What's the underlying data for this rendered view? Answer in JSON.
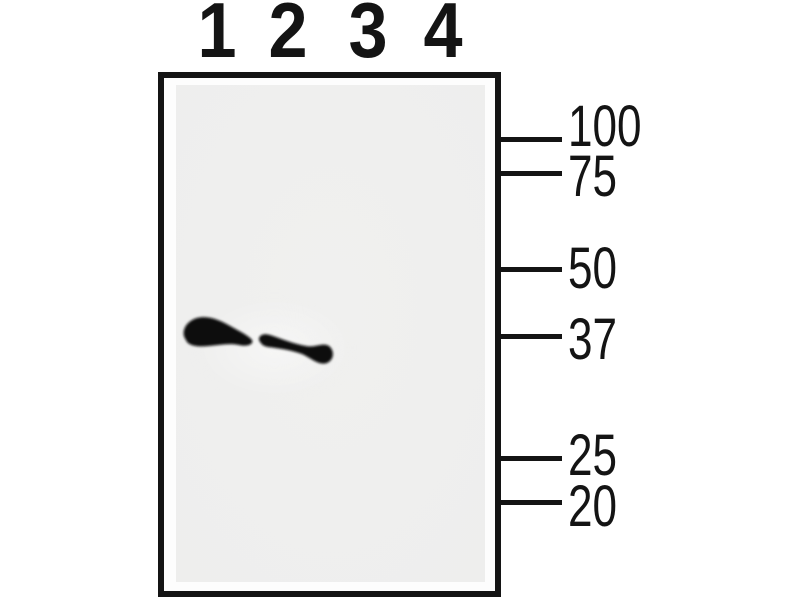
{
  "figure": {
    "kind": "western-blot",
    "lane_labels": [
      "1",
      "2",
      "3",
      "4"
    ],
    "marker_labels": [
      "100",
      "75",
      "50",
      "37",
      "25",
      "20"
    ],
    "bands": [
      {
        "lane": "1",
        "near_marker": "37",
        "intensity": "strong"
      },
      {
        "lane": "2",
        "near_marker": "37",
        "intensity": "strong"
      }
    ],
    "empty_lanes": [
      "3",
      "4"
    ],
    "colors": {
      "ink": "#141414",
      "gel": "#eeeeed",
      "band": "#0c0c0c",
      "background": "#ffffff"
    }
  }
}
